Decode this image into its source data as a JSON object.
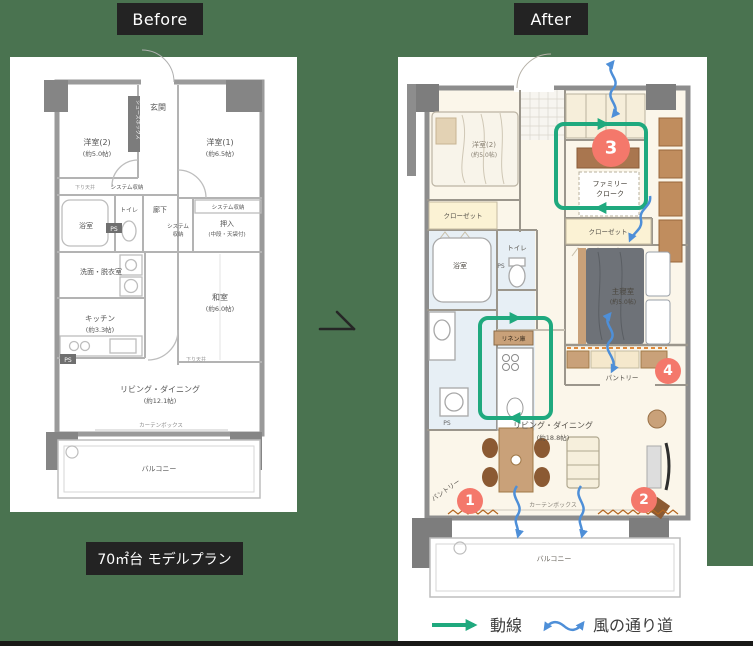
{
  "page": {
    "before_tab": "Before",
    "after_tab": "After",
    "caption": "70㎡台 モデルプラン"
  },
  "colors": {
    "background": "#4A7350",
    "accent_green": "#1FA97E",
    "accent_blue": "#4E8FD8",
    "marker_red": "#F4786B",
    "wall_gray": "#8D8D8D",
    "wood_tan": "#C9A179"
  },
  "before_plan": {
    "genkan": "玄関",
    "shoes_box": "シューズボックス",
    "yoshitsu2_name": "洋室(2)",
    "yoshitsu2_size": "(約5.0帖)",
    "yoshitsu1_name": "洋室(1)",
    "yoshitsu1_size": "(約6.5帖)",
    "system_storage_a": "システム収納",
    "system_storage_b_line1": "システム",
    "system_storage_b_line2": "収納",
    "system_storage_c": "システム収納",
    "sagari_tenjo": "下り天井",
    "roka": "廊下",
    "toilet": "トイレ",
    "oshiire_name": "押入",
    "oshiire_note": "(中段・天袋付)",
    "bathroom": "浴室",
    "senmen": "洗面・脱衣室",
    "kitchen_name": "キッチン",
    "kitchen_size": "(約3.3帖)",
    "washitsu_name": "和室",
    "washitsu_size": "(約6.0帖)",
    "living_name": "リビング・ダイニング",
    "living_size": "(約12.1帖)",
    "curtain_box": "カーテンボックス",
    "balcony": "バルコニー",
    "ps": "PS"
  },
  "after_plan": {
    "yoshitsu2_name": "洋室(2)",
    "yoshitsu2_size": "(約5.0帖)",
    "family_cloak_line1": "ファミリー",
    "family_cloak_line2": "クローク",
    "closet_left": "クローゼット",
    "closet_right": "クローゼット",
    "bathroom": "浴室",
    "toilet": "トイレ",
    "ps": "PS",
    "master_name": "主寝室",
    "master_size": "(約5.0帖)",
    "linen": "リネン庫",
    "pantry_right": "パントリー",
    "pantry_left": "パントリー",
    "living_name": "リビング・ダイニング",
    "living_size": "(約18.8帖)",
    "curtain_box": "カーテンボックス",
    "balcony": "バルコニー",
    "markers": [
      "1",
      "2",
      "3",
      "4"
    ]
  },
  "legend": {
    "flow": "動線",
    "wind": "風の通り道"
  }
}
